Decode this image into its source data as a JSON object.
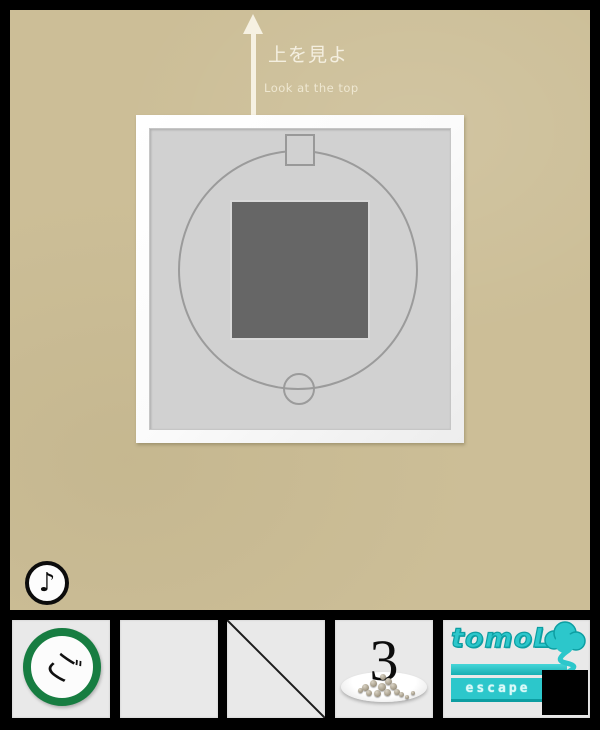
{
  "scene": {
    "bg_color": "#ccbe97",
    "hint": {
      "jp": "上を見よ",
      "en": "Look at the top"
    },
    "panel": {
      "frame_color": "#fafafa",
      "inner_color": "#d1d1d1",
      "outline_color": "#9b9b9b",
      "dark_square_color": "#666666"
    },
    "sound_button": {
      "glyph": "♪"
    }
  },
  "inventory": {
    "bar_color": "#000000",
    "slot_color": "#e9e9e9",
    "slots": [
      {
        "id": "go-badge",
        "label": "ご",
        "ring_color": "#177d41"
      },
      {
        "id": "empty"
      },
      {
        "id": "crossed-out"
      },
      {
        "id": "plate-of-seeds",
        "count": "3"
      },
      {
        "id": "brand-logo",
        "title": "tomoLa",
        "subtitle": "escape",
        "accent_color": "#2cc7cb"
      }
    ]
  }
}
